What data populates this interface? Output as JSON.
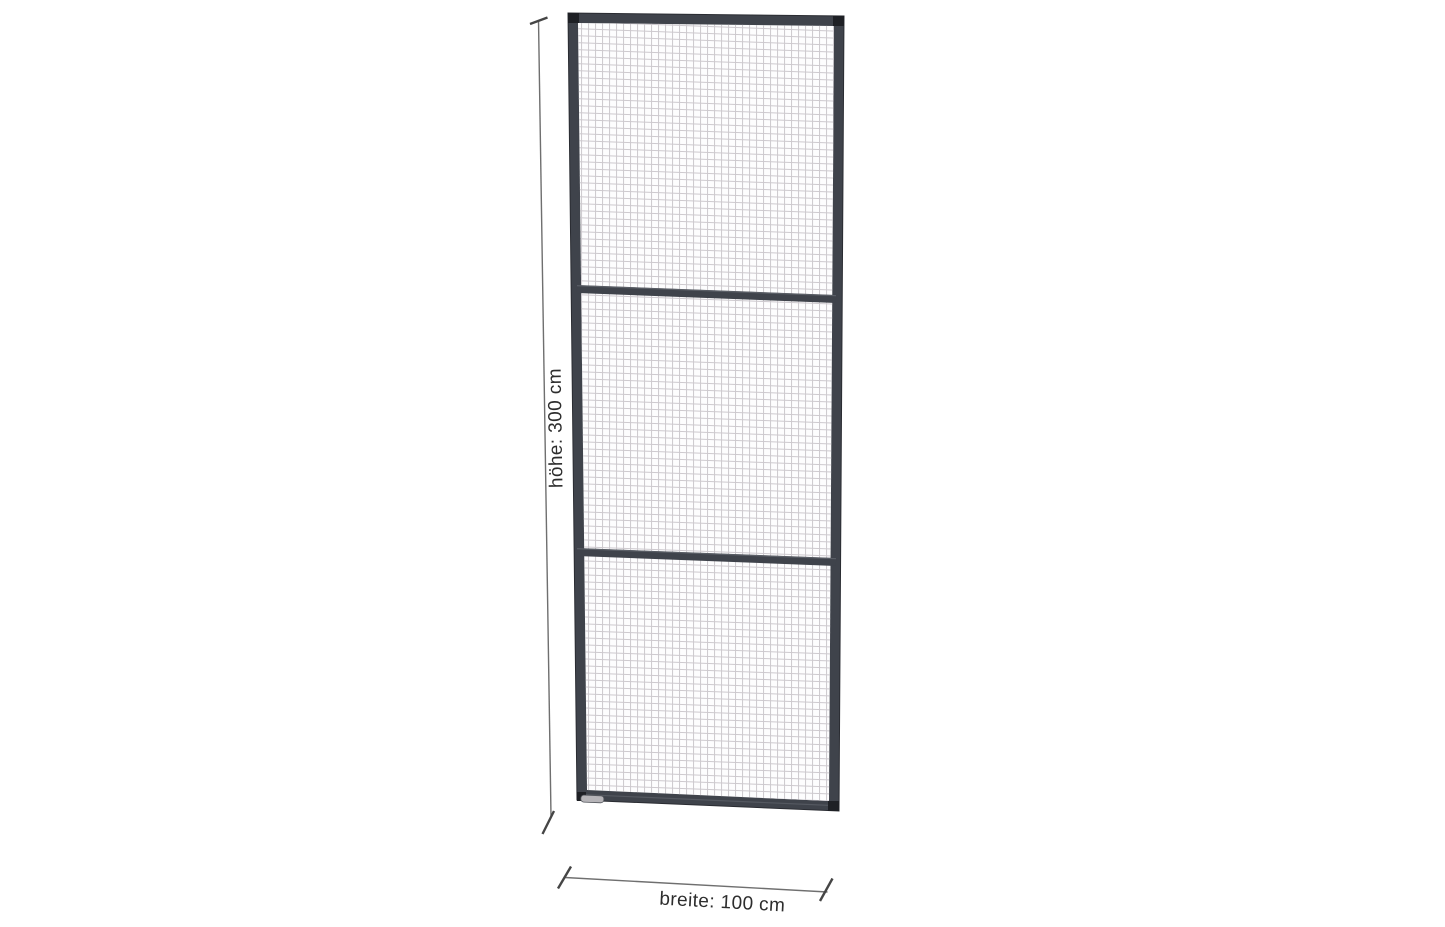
{
  "page": {
    "background_color": "#ffffff"
  },
  "drawing": {
    "subject": "wire-mesh-partition-panel-technical-drawing",
    "panel": {
      "sections": 3,
      "frame_color": "#3f434b",
      "frame_edge_color": "#2a2c32",
      "corner_cap_color": "#1e2025",
      "crossbar_color": "#3f434b",
      "crossbar_highlight_color": "#6a6e76",
      "mesh_line_color": "#c8c4c9",
      "mesh_background_color": "#fdfdfe",
      "foot_plate_color": "#b6b4b8",
      "foot_plate_edge_color": "#53565c"
    },
    "dimension_style": {
      "line_color": "#6f6f6f",
      "tick_color": "#454545",
      "text_color": "#2d2d2d"
    },
    "dimensions": {
      "height": {
        "label": "höhe: 300 cm",
        "value": "300",
        "unit": "cm"
      },
      "width": {
        "label": "breite: 100 cm",
        "value": "100",
        "unit": "cm"
      }
    }
  }
}
